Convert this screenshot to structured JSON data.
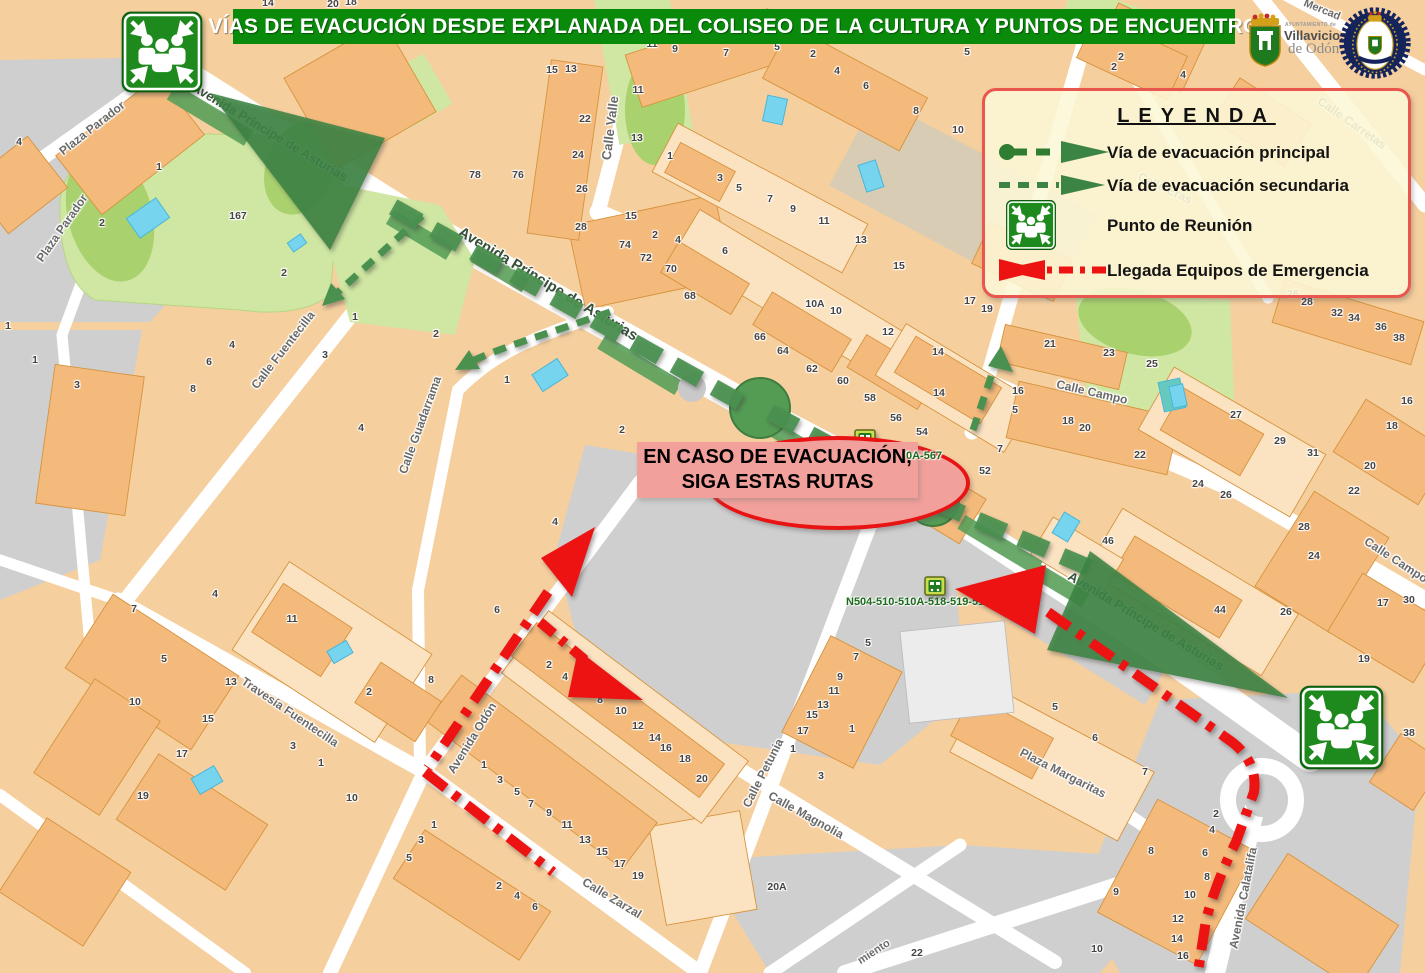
{
  "title_banner": {
    "text": "VÍAS DE EVACUCIÓN DESDE EXPLANADA DEL COLISEO DE LA CULTURA Y PUNTOS DE ENCUENTRO"
  },
  "legend": {
    "title": "LEYENDA",
    "items": [
      {
        "name": "principal-route",
        "label": "Vía de evacuación principal"
      },
      {
        "name": "secondary-route",
        "label": "Vía de evacuación secundaria"
      },
      {
        "name": "meeting-point",
        "label": "Punto de Reunión"
      },
      {
        "name": "emergency-arrival",
        "label": "Llegada Equipos de Emergencia"
      }
    ]
  },
  "callout": {
    "line1": "EN CASO DE EVACUACIÓN,",
    "line2": "SIGA ESTAS RUTAS"
  },
  "logos": {
    "ayuntamiento_line1": "AYUNTAMIENTO de",
    "ayuntamiento_line2": "Villaviciosa",
    "ayuntamiento_line3": "de Odón"
  },
  "bus_stops": [
    {
      "routes": "0A-567"
    },
    {
      "routes": "N504-510-510A-518-519-519A-567"
    }
  ],
  "colors": {
    "banner_green": "#0a8a0a",
    "route_green": "#4a9150",
    "route_green_dark": "#3c8443",
    "route_red": "#ee1313",
    "legend_bg": "#fcf7d6",
    "legend_border": "#e8564e",
    "meeting_icon_green": "#1e8a1e",
    "block_peach": "#f6cf9e",
    "building_peach": "#f3ba7c",
    "park_green": "#cfe7a2",
    "water_blue": "#76d4ee",
    "road_white": "#ffffff",
    "plaza_grey": "#cfcfcf"
  },
  "map": {
    "streets": [
      {
        "t": "Plaza Parador",
        "x": 92,
        "y": 128,
        "r": -38
      },
      {
        "t": "Plaza Parador",
        "x": 62,
        "y": 228,
        "r": -55
      },
      {
        "t": "Avenida Príncipe de Asturias",
        "x": 270,
        "y": 132,
        "r": 31,
        "c": "green",
        "fs": 13
      },
      {
        "t": "Avenida Príncipe de Asturias",
        "x": 548,
        "y": 284,
        "r": 31,
        "c": "green",
        "fs": 15
      },
      {
        "t": "Avenida Príncipe de Asturias",
        "x": 1146,
        "y": 621,
        "r": 31,
        "c": "green",
        "fs": 13
      },
      {
        "t": "Calle Fuentecilla",
        "x": 283,
        "y": 350,
        "r": -52
      },
      {
        "t": "Calle Guadarrama",
        "x": 420,
        "y": 425,
        "r": -70
      },
      {
        "t": "Calle Valle",
        "x": 610,
        "y": 128,
        "r": -83,
        "fs": 13
      },
      {
        "t": "Calle Campo",
        "x": 1092,
        "y": 392,
        "r": 13
      },
      {
        "t": "Calle Campo",
        "x": 1396,
        "y": 560,
        "r": 33
      },
      {
        "t": "Calle Carretas",
        "x": 1352,
        "y": 123,
        "r": 35
      },
      {
        "t": "Calle Eras",
        "x": 1165,
        "y": 188,
        "r": 25
      },
      {
        "t": "Mercad",
        "x": 1322,
        "y": 10,
        "r": 22,
        "fs": 11
      },
      {
        "t": "Travesía Fuentecilla",
        "x": 290,
        "y": 712,
        "r": 34
      },
      {
        "t": "Avenida Odón",
        "x": 472,
        "y": 738,
        "r": -58
      },
      {
        "t": "Calle Petunia",
        "x": 763,
        "y": 773,
        "r": -63
      },
      {
        "t": "Calle Magnolia",
        "x": 806,
        "y": 815,
        "r": 29
      },
      {
        "t": "Calle Zarzal",
        "x": 612,
        "y": 898,
        "r": 31
      },
      {
        "t": "Plaza Margaritas",
        "x": 1063,
        "y": 773,
        "r": 27
      },
      {
        "t": "Avenida Calatalifa",
        "x": 1243,
        "y": 898,
        "r": -79
      },
      {
        "t": "miento",
        "x": 874,
        "y": 952,
        "r": -33,
        "fs": 11
      }
    ],
    "house_numbers": [
      [
        19,
        142,
        "4"
      ],
      [
        159,
        167,
        "1"
      ],
      [
        102,
        223,
        "2"
      ],
      [
        238,
        216,
        "167"
      ],
      [
        284,
        273,
        "2"
      ],
      [
        8,
        326,
        "1"
      ],
      [
        35,
        360,
        "1"
      ],
      [
        77,
        385,
        "3"
      ],
      [
        232,
        345,
        "4"
      ],
      [
        209,
        362,
        "6"
      ],
      [
        193,
        389,
        "8"
      ],
      [
        325,
        355,
        "3"
      ],
      [
        355,
        317,
        "1"
      ],
      [
        475,
        175,
        "78"
      ],
      [
        518,
        175,
        "76"
      ],
      [
        582,
        189,
        "26"
      ],
      [
        581,
        227,
        "28"
      ],
      [
        631,
        216,
        "15"
      ],
      [
        655,
        235,
        "2"
      ],
      [
        625,
        245,
        "74"
      ],
      [
        646,
        258,
        "72"
      ],
      [
        671,
        269,
        "70"
      ],
      [
        436,
        334,
        "2"
      ],
      [
        507,
        380,
        "1"
      ],
      [
        361,
        428,
        "4"
      ],
      [
        652,
        44,
        "11"
      ],
      [
        675,
        49,
        "9"
      ],
      [
        726,
        53,
        "7"
      ],
      [
        777,
        47,
        "5"
      ],
      [
        813,
        54,
        "2"
      ],
      [
        837,
        71,
        "4"
      ],
      [
        866,
        86,
        "6"
      ],
      [
        916,
        111,
        "8"
      ],
      [
        958,
        130,
        "10"
      ],
      [
        552,
        70,
        "15"
      ],
      [
        571,
        69,
        "13"
      ],
      [
        638,
        90,
        "11"
      ],
      [
        585,
        119,
        "22"
      ],
      [
        578,
        155,
        "24"
      ],
      [
        637,
        138,
        "13"
      ],
      [
        670,
        156,
        "1"
      ],
      [
        720,
        178,
        "3"
      ],
      [
        739,
        188,
        "5"
      ],
      [
        770,
        199,
        "7"
      ],
      [
        793,
        209,
        "9"
      ],
      [
        824,
        221,
        "11"
      ],
      [
        861,
        240,
        "13"
      ],
      [
        899,
        266,
        "15"
      ],
      [
        678,
        240,
        "4"
      ],
      [
        725,
        251,
        "6"
      ],
      [
        690,
        296,
        "68"
      ],
      [
        967,
        52,
        "5"
      ],
      [
        760,
        337,
        "66"
      ],
      [
        783,
        351,
        "64"
      ],
      [
        812,
        369,
        "62"
      ],
      [
        843,
        381,
        "60"
      ],
      [
        870,
        398,
        "58"
      ],
      [
        896,
        418,
        "56"
      ],
      [
        922,
        432,
        "54"
      ],
      [
        815,
        304,
        "10A"
      ],
      [
        836,
        311,
        "10"
      ],
      [
        888,
        332,
        "12"
      ],
      [
        938,
        352,
        "14"
      ],
      [
        939,
        393,
        "14"
      ],
      [
        970,
        301,
        "17"
      ],
      [
        987,
        309,
        "19"
      ],
      [
        622,
        430,
        "2"
      ],
      [
        985,
        471,
        "52"
      ],
      [
        1050,
        344,
        "21"
      ],
      [
        1109,
        353,
        "23"
      ],
      [
        1152,
        364,
        "25"
      ],
      [
        1018,
        391,
        "16"
      ],
      [
        1015,
        410,
        "5"
      ],
      [
        1068,
        421,
        "18"
      ],
      [
        1085,
        428,
        "20"
      ],
      [
        1000,
        449,
        "7"
      ],
      [
        1140,
        455,
        "22"
      ],
      [
        1293,
        294,
        "26"
      ],
      [
        1307,
        302,
        "28"
      ],
      [
        1337,
        313,
        "32"
      ],
      [
        1354,
        318,
        "34"
      ],
      [
        1381,
        327,
        "36"
      ],
      [
        1399,
        338,
        "38"
      ],
      [
        1236,
        415,
        "27"
      ],
      [
        1280,
        441,
        "29"
      ],
      [
        1313,
        453,
        "31"
      ],
      [
        1407,
        401,
        "16"
      ],
      [
        1392,
        426,
        "18"
      ],
      [
        1370,
        466,
        "20"
      ],
      [
        1354,
        491,
        "22"
      ],
      [
        1198,
        484,
        "24"
      ],
      [
        1226,
        495,
        "26"
      ],
      [
        1383,
        603,
        "17"
      ],
      [
        1409,
        600,
        "30"
      ],
      [
        1364,
        659,
        "19"
      ],
      [
        1108,
        541,
        "46"
      ],
      [
        1220,
        610,
        "44"
      ],
      [
        1304,
        527,
        "28"
      ],
      [
        1314,
        556,
        "24"
      ],
      [
        1286,
        612,
        "26"
      ],
      [
        1055,
        707,
        "5"
      ],
      [
        1095,
        738,
        "6"
      ],
      [
        1145,
        772,
        "7"
      ],
      [
        1216,
        814,
        "2"
      ],
      [
        1212,
        830,
        "4"
      ],
      [
        1205,
        853,
        "6"
      ],
      [
        1207,
        877,
        "8"
      ],
      [
        1151,
        851,
        "8"
      ],
      [
        1190,
        895,
        "10"
      ],
      [
        1116,
        892,
        "9"
      ],
      [
        1178,
        919,
        "12"
      ],
      [
        1177,
        939,
        "14"
      ],
      [
        1183,
        956,
        "16"
      ],
      [
        1097,
        949,
        "10"
      ],
      [
        1409,
        733,
        "38"
      ],
      [
        431,
        680,
        "8"
      ],
      [
        549,
        665,
        "2"
      ],
      [
        565,
        677,
        "4"
      ],
      [
        583,
        691,
        "6"
      ],
      [
        600,
        700,
        "8"
      ],
      [
        621,
        711,
        "10"
      ],
      [
        638,
        726,
        "12"
      ],
      [
        655,
        738,
        "14"
      ],
      [
        666,
        748,
        "16"
      ],
      [
        685,
        759,
        "18"
      ],
      [
        702,
        779,
        "20"
      ],
      [
        484,
        765,
        "1"
      ],
      [
        500,
        780,
        "3"
      ],
      [
        517,
        792,
        "5"
      ],
      [
        531,
        804,
        "7"
      ],
      [
        549,
        813,
        "9"
      ],
      [
        567,
        825,
        "11"
      ],
      [
        585,
        840,
        "13"
      ],
      [
        602,
        852,
        "15"
      ],
      [
        620,
        864,
        "17"
      ],
      [
        638,
        876,
        "19"
      ],
      [
        434,
        825,
        "1"
      ],
      [
        421,
        840,
        "3"
      ],
      [
        409,
        858,
        "5"
      ],
      [
        499,
        886,
        "2"
      ],
      [
        517,
        896,
        "4"
      ],
      [
        535,
        907,
        "6"
      ],
      [
        868,
        643,
        "5"
      ],
      [
        856,
        657,
        "7"
      ],
      [
        840,
        677,
        "9"
      ],
      [
        834,
        691,
        "11"
      ],
      [
        823,
        705,
        "13"
      ],
      [
        812,
        715,
        "15"
      ],
      [
        803,
        731,
        "17"
      ],
      [
        852,
        729,
        "1"
      ],
      [
        793,
        749,
        "1"
      ],
      [
        821,
        776,
        "3"
      ],
      [
        777,
        887,
        "20A"
      ],
      [
        215,
        594,
        "4"
      ],
      [
        134,
        609,
        "7"
      ],
      [
        164,
        659,
        "5"
      ],
      [
        135,
        702,
        "10"
      ],
      [
        231,
        682,
        "13"
      ],
      [
        208,
        719,
        "15"
      ],
      [
        182,
        754,
        "17"
      ],
      [
        143,
        796,
        "19"
      ],
      [
        292,
        619,
        "11"
      ],
      [
        293,
        746,
        "3"
      ],
      [
        321,
        763,
        "1"
      ],
      [
        369,
        692,
        "2"
      ],
      [
        352,
        798,
        "10"
      ],
      [
        917,
        953,
        "22"
      ],
      [
        555,
        522,
        "4"
      ],
      [
        497,
        610,
        "6"
      ],
      [
        1121,
        57,
        "2"
      ],
      [
        1114,
        67,
        "2"
      ],
      [
        1183,
        75,
        "4"
      ],
      [
        268,
        3,
        "14"
      ],
      [
        333,
        4,
        "20"
      ],
      [
        351,
        2,
        "18"
      ]
    ]
  }
}
